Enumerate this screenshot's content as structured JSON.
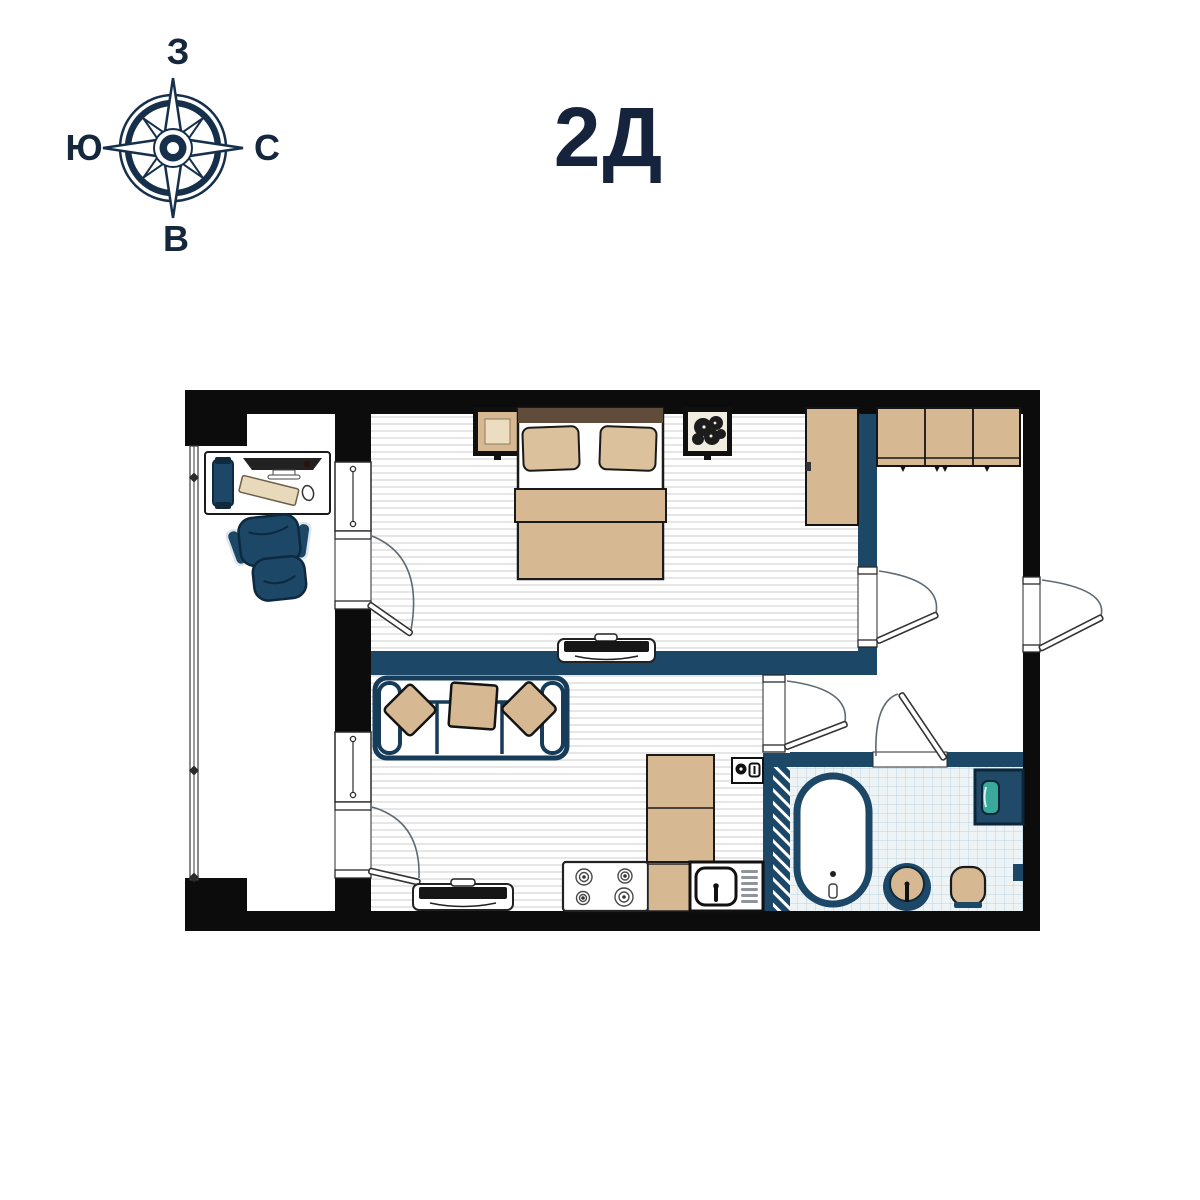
{
  "title": "2Д",
  "compass": {
    "top": "З",
    "right": "С",
    "bottom": "В",
    "left": "Ю"
  },
  "palette": {
    "ink_navy": "#15233c",
    "wall_outer": "#0c0c0c",
    "wall_inner": "#1c4767",
    "furniture_tan": "#d6b993",
    "furniture_tan_light": "#e9d9bd",
    "headboard_brown": "#5f4c3a",
    "appliance_teal": "#39a99b",
    "floor_stripe": "#d9d9d9",
    "tile_bg": "#eef4f6",
    "tile_line": "#b9d3dd",
    "screen_dark": "#161616"
  },
  "plan_items": [
    "compass-rose",
    "balcony",
    "desk",
    "computer-monitor",
    "office-chair",
    "double-bed",
    "nightstand",
    "plant",
    "wardrobe",
    "tv-console",
    "sofa",
    "cushions",
    "stove",
    "kitchen-counter",
    "kitchen-sink",
    "fridge",
    "bathtub",
    "washbasin",
    "toilet",
    "washing-machine",
    "hallway-closet",
    "entrance-door",
    "interior-doors",
    "windows"
  ]
}
